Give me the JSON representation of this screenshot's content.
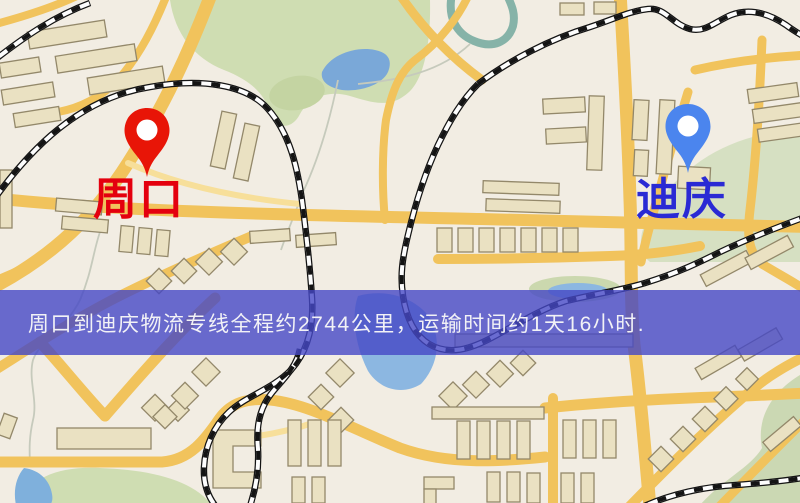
{
  "origin": {
    "name": "周口",
    "pin_color": "#e81507",
    "label_color": "#e4000e"
  },
  "destination": {
    "name": "迪庆",
    "pin_color": "#4b85ee",
    "label_color": "#2a2ad4"
  },
  "banner": {
    "text": "周口到迪庆物流专线全程约2744公里，运输时间约1天16小时.",
    "bg_color": "#4547c5",
    "text_color": "#f2f2f6"
  },
  "map_palette": {
    "background": "#f2ede3",
    "road_major": "#f1c35c",
    "road_minor": "#f7df9a",
    "building_fill": "#eae1c2",
    "building_outline": "#93886a",
    "park_green": "#cfddb2",
    "water_blue": "#8cb7e1",
    "river_teal": "#86b3a8",
    "railway_dark": "#141414",
    "railway_light": "#fdfdfd"
  }
}
